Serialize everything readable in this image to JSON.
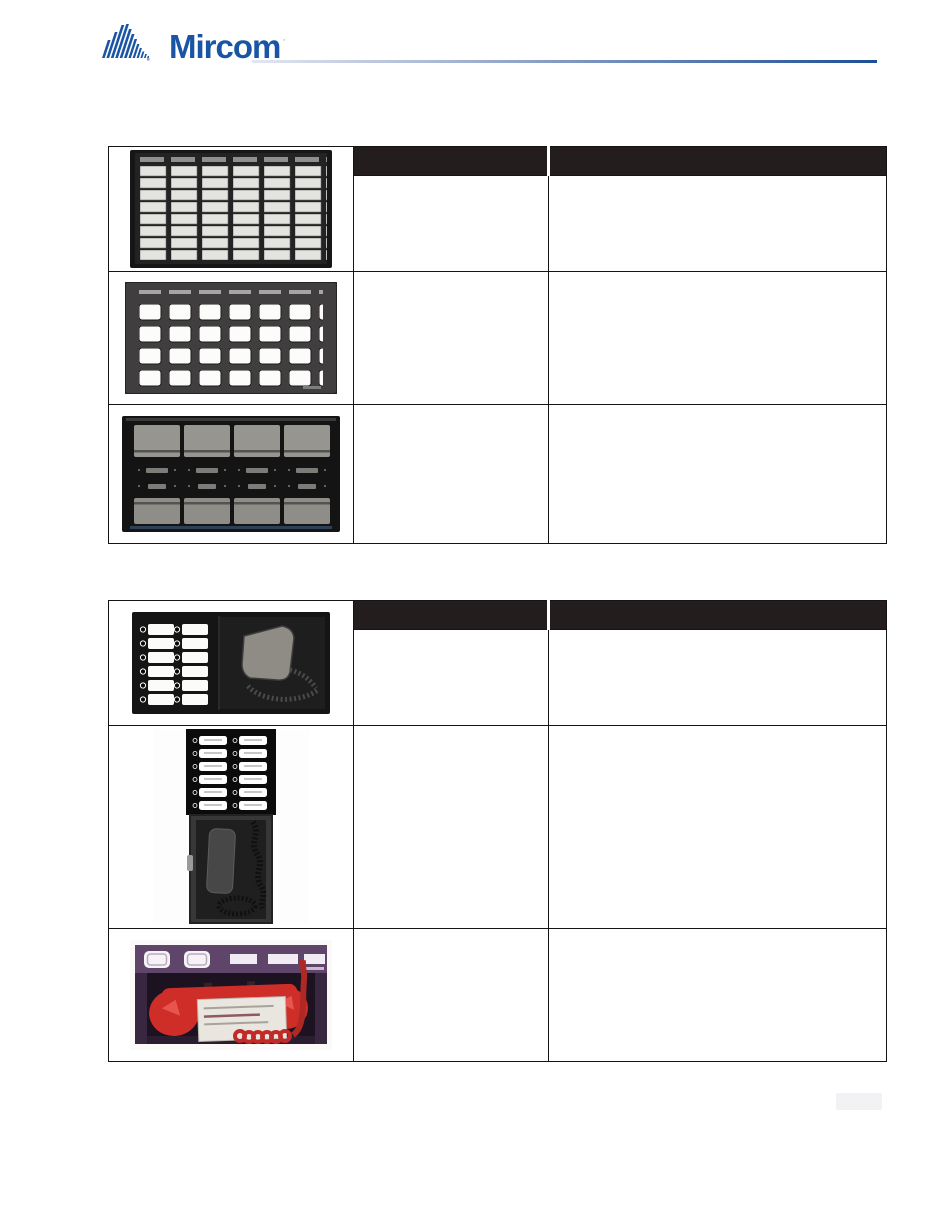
{
  "page": {
    "background": "#ffffff"
  },
  "header": {
    "logo_text": "Mircom",
    "logo_registered_mark": "·",
    "logo_color": "#1a55a4",
    "divider_gradient_start": "#e2e7f1",
    "divider_gradient_end": "#1d4f94"
  },
  "tables": [
    {
      "id": "annunciator-panels-table",
      "header": {
        "model_label": "",
        "description_label": "",
        "background": "#231d1e"
      },
      "rows": [
        {
          "image_name": "48-zone-led-annunciator-panel",
          "model": "",
          "description": ""
        },
        {
          "image_name": "24-zone-annunciator-faceplate",
          "model": "",
          "description": ""
        },
        {
          "image_name": "8-button-control-annunciator-panel",
          "model": "",
          "description": ""
        }
      ]
    },
    {
      "id": "audio-and-telephone-table",
      "header": {
        "model_label": "",
        "description_label": "",
        "background": "#231d1e"
      },
      "rows": [
        {
          "image_name": "paging-microphone-selector-panel",
          "model": "",
          "description": ""
        },
        {
          "image_name": "telephone-selector-panel-with-handset-cabinet",
          "model": "",
          "description": ""
        },
        {
          "image_name": "red-firefighter-telephone-handset-cabinet",
          "model": "",
          "description": ""
        }
      ]
    }
  ],
  "footer": {
    "page_tab_text": ""
  }
}
